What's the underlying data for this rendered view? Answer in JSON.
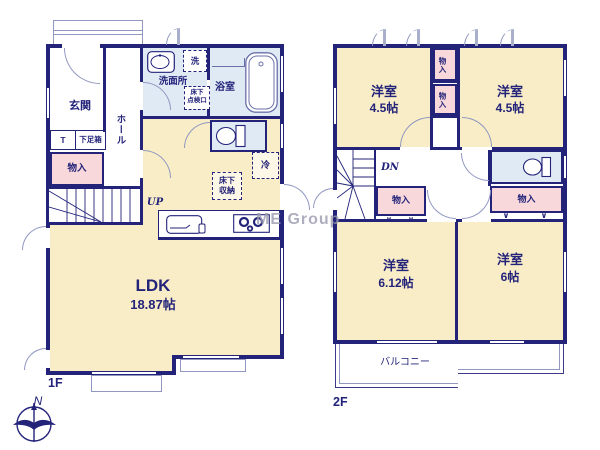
{
  "watermark": "ME Group",
  "compass": {
    "north_label": "N"
  },
  "colors": {
    "wall_navy": "#23237a",
    "room_cream": "#f9edc7",
    "closet_pink": "#f8d8da",
    "wet_blue": "#e0eaf5",
    "fixture_line": "#9098c0",
    "watermark_gray": "#9a9aae"
  },
  "floor1": {
    "floor_label": "1F",
    "entrance_label": "玄関",
    "hall_label": "ホール",
    "doormat_label": "T",
    "shoe_cabinet_label": "下足箱",
    "storage_label": "物入",
    "stairs_label": "UP",
    "washroom_label": "洗面所",
    "washer_label": "洗",
    "underfloor_access_line1": "床下",
    "underfloor_access_line2": "点検口",
    "bathroom_label": "浴室",
    "refrigerator_label": "冷",
    "underfloor_storage_line1": "床下",
    "underfloor_storage_line2": "収納",
    "ldk_label": "LDK",
    "ldk_size": "18.87帖"
  },
  "floor2": {
    "floor_label": "2F",
    "room_nw_label": "洋室",
    "room_nw_size": "4.5帖",
    "room_ne_label": "洋室",
    "room_ne_size": "4.5帖",
    "closet_top1_label": "物入",
    "closet_top2_label": "物入",
    "stairs_label": "DN",
    "closet_left_label": "物入",
    "closet_right_label": "物入",
    "closet_mark": "∨",
    "room_sw_label": "洋室",
    "room_sw_size": "6.12帖",
    "room_se_label": "洋室",
    "room_se_size": "6帖",
    "balcony_label": "バルコニー"
  }
}
